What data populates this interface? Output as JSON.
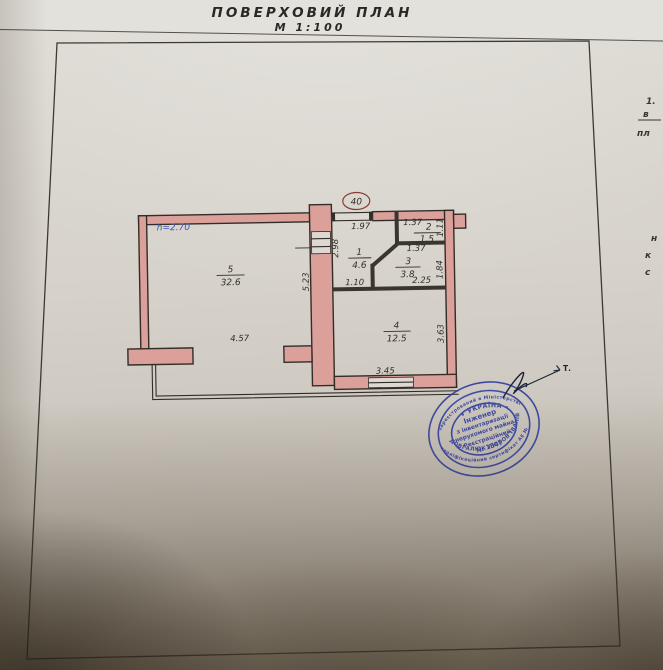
{
  "page": {
    "title": "ПОВЕРХОВИЙ  ПЛАН",
    "scale": "М 1:100"
  },
  "plan": {
    "apartment_number": "40",
    "height_note": "h=2.70",
    "rooms": {
      "r1": {
        "num": "1",
        "area": "4.6"
      },
      "r2": {
        "num": "2",
        "area": "1.5"
      },
      "r3": {
        "num": "3",
        "area": "3.8"
      },
      "r4": {
        "num": "4",
        "area": "12.5"
      },
      "r5": {
        "num": "5",
        "area": "32.6"
      }
    },
    "dims": {
      "top_197": "1.97",
      "top_137": "1.37",
      "right_111": "1.11",
      "left_298": "2.98",
      "mid_137": "1.37",
      "right_184": "1.84",
      "bot_110": "1.10",
      "bot_225": "2.25",
      "v_523": "5.23",
      "h_457": "4.57",
      "v_363": "3.63",
      "bot_345": "3.45"
    },
    "colors": {
      "wall": "#dca09b",
      "outline": "#322d27",
      "ink_blue": "#3d55a8",
      "room2_red": "#b0443a"
    }
  },
  "stamp": {
    "color": "#2b3a9d",
    "outer_top": "зареєстрований в Міністерстві",
    "outer_bottom": "кваліфікаційний сертифікат АЕ №",
    "ring_top": "• УКРАЇНА •",
    "ring_name": "ДОВГАЛЮК ЛЮБОВ ІВАНІВНА",
    "center_lines": {
      "0": "Інженер",
      "1": "з інвентаризації",
      "2": "нерухомого майна",
      "3": "Реєстраційний",
      "4": "№ 1547"
    }
  },
  "annotations": {
    "sig_label": "Т.",
    "side_fragments": {
      "0": "1.",
      "1": "в",
      "2": "пл",
      "3": "н",
      "4": "к",
      "5": "с"
    }
  }
}
